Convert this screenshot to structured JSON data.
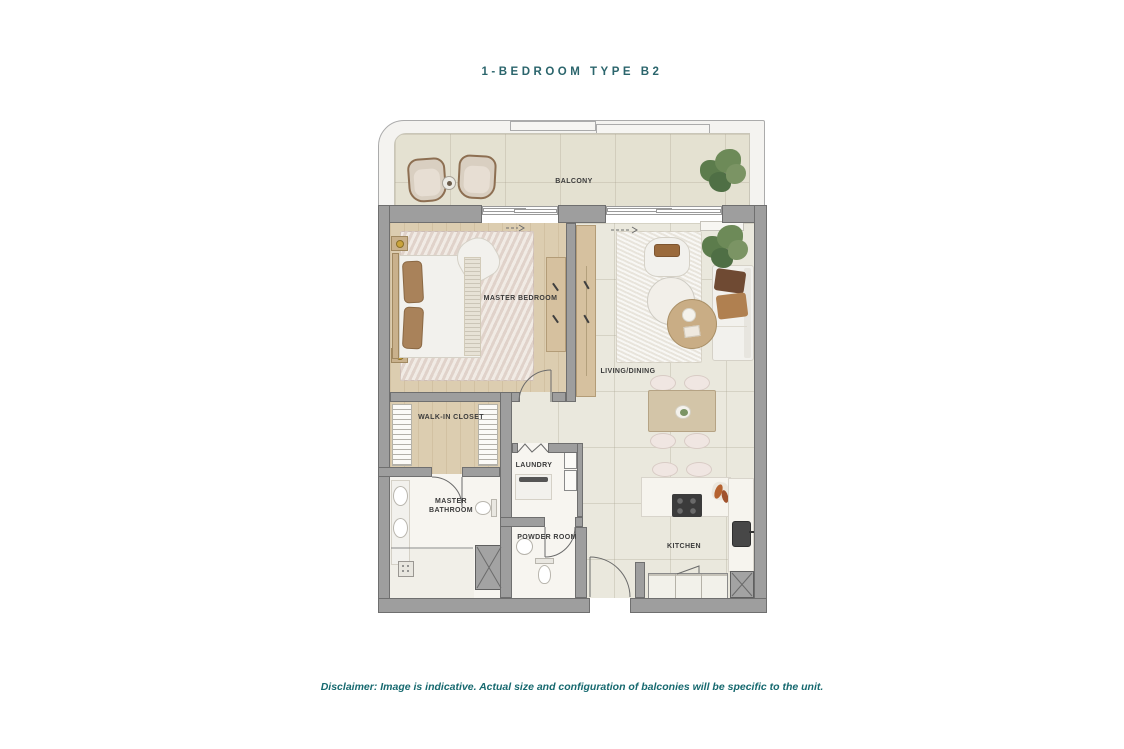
{
  "page": {
    "title": "1-BEDROOM TYPE B2",
    "disclaimer": "Disclaimer: Image is indicative. Actual size and configuration of balconies will be specific to the unit."
  },
  "rooms": {
    "balcony": "BALCONY",
    "master_bedroom": "MASTER BEDROOM",
    "living_dining": "LIVING/DINING",
    "walk_in_closet": "WALK-IN CLOSET",
    "laundry": "LAUNDRY",
    "master_bathroom": "MASTER BATHROOM",
    "powder_room": "POWDER ROOM",
    "kitchen": "KITCHEN"
  },
  "colors": {
    "title_text": "#2b656c",
    "disclaimer_text": "#16696f",
    "wall": "#9e9e9e",
    "wall_outline": "#6f6f6f",
    "balcony_floor": "#e4e1d1",
    "tile_floor": "#eae8dd",
    "wood_floor": "#dccdb0",
    "marble_floor": "#f7f5f0",
    "label_text": "#3b3b3b"
  }
}
